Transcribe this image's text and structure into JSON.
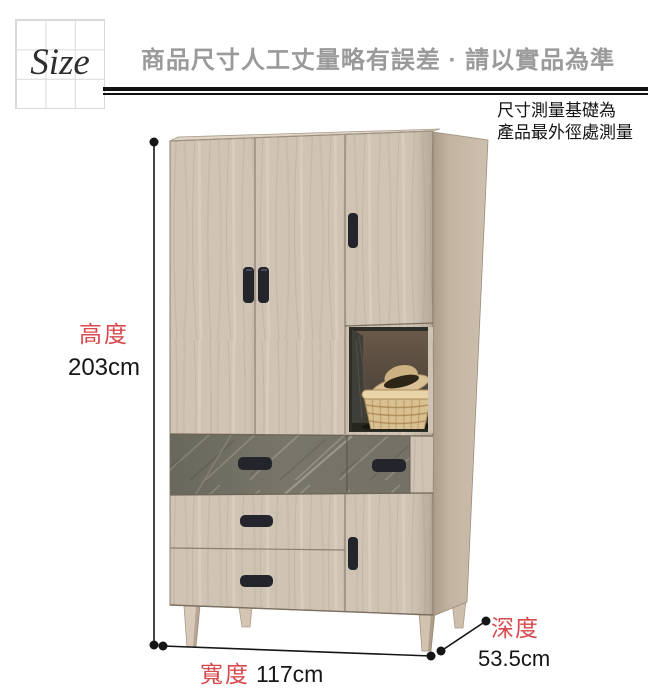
{
  "header": {
    "size_label": "Size",
    "title": "商品尺寸人工丈量略有誤差 · 請以實品為準"
  },
  "note": {
    "line1": "尺寸測量基礎為",
    "line2": "產品最外徑處測量"
  },
  "dimensions": {
    "height": {
      "label": "高度",
      "value": "203cm"
    },
    "width": {
      "label": "寬度",
      "value": "117cm"
    },
    "depth": {
      "label": "深度",
      "value": "53.5cm"
    }
  },
  "colors": {
    "accent_red": "#d8494d",
    "heading_gray": "#9a9a9a",
    "wood_front": "#cfc3b3",
    "wood_side": "#c2b3a1",
    "stone_drawer": "#7a786c",
    "handle_black": "#23242c",
    "dimension_line": "#161616",
    "grid_line": "#d9d9d9"
  }
}
